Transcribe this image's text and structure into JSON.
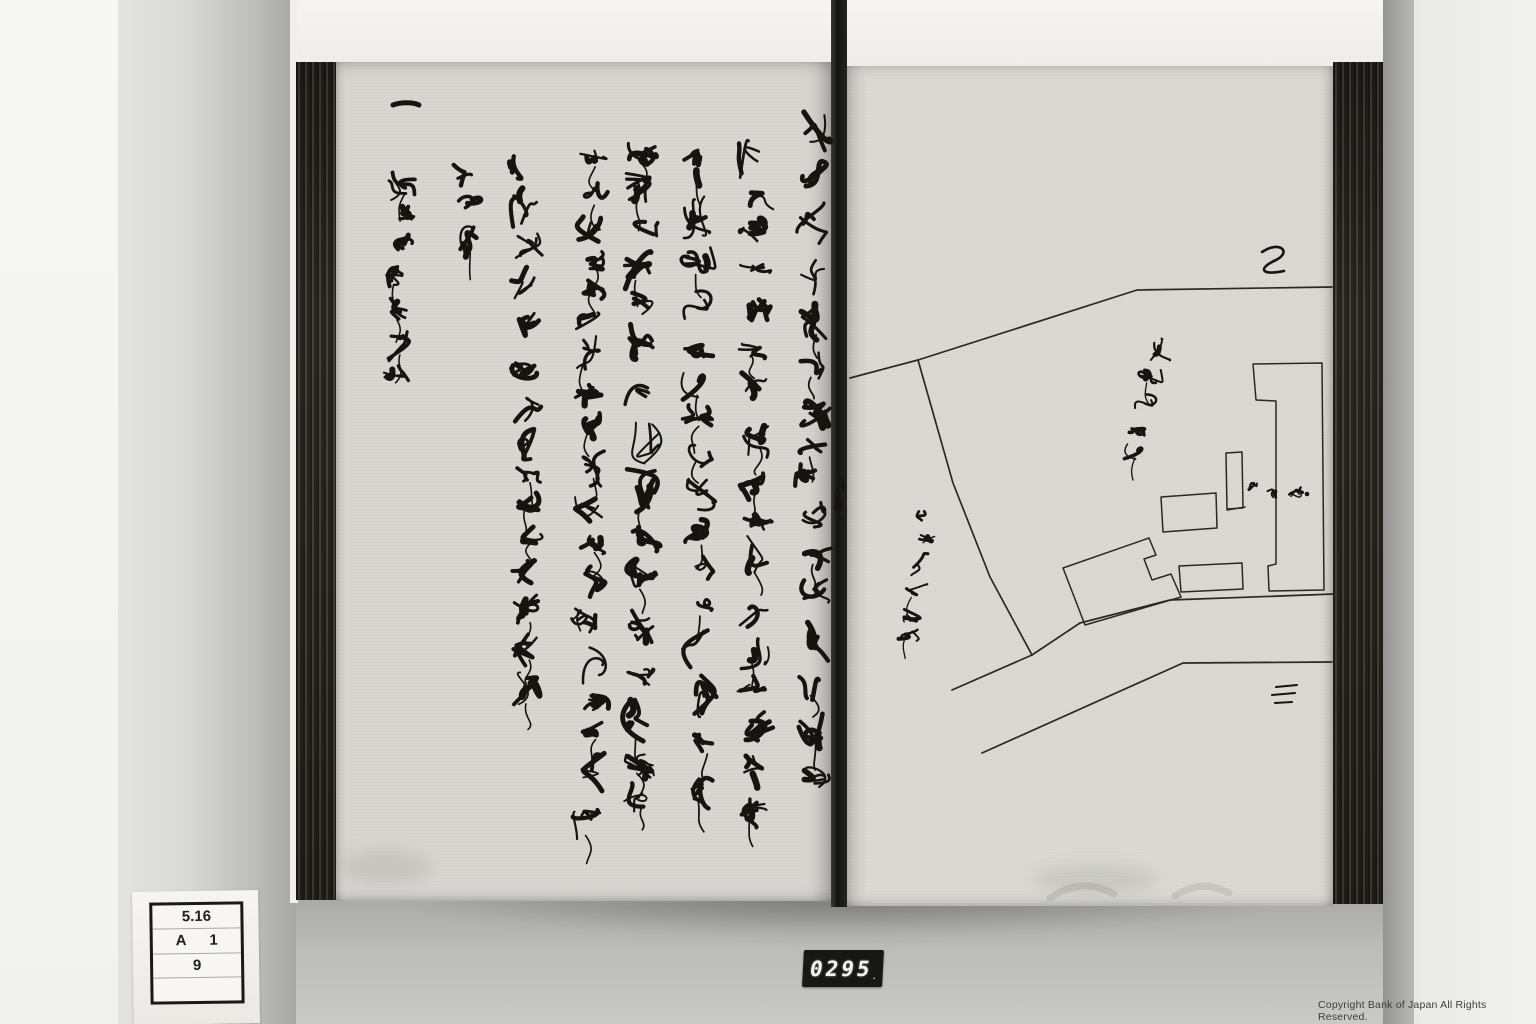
{
  "image_type": "black-and-white archival photograph of an open stitch-bound Japanese manuscript, left page handwritten cursive text, right page hand-drawn plot map",
  "overlays": {
    "label_card": {
      "rows": [
        [
          "5.16"
        ],
        [
          "A",
          "1"
        ],
        [
          "9"
        ],
        [
          ""
        ]
      ]
    },
    "counter": {
      "value": "0295",
      "dot": "."
    },
    "copyright": "Copyright Bank of Japan All Rights Reserved."
  },
  "palette": {
    "ink": "#17140f",
    "map_ink": "#2b2823",
    "paper_left": "#d7d6d1",
    "paper_right": "#dad9d4",
    "binding": "#332f28",
    "backdrop": "#c6c6c4"
  },
  "book": {
    "left_page": {
      "script": "cursive kuzushiji, vertical columns read right to left; largely illegible",
      "legible_fragments": "一 / 中 / 大坂店加番 / 御場 (approximate readings of cursive)",
      "heading_dash": {
        "x1": 393,
        "y": 105,
        "x2": 419
      },
      "gutter_mark": {
        "x": 843,
        "y1": 476,
        "y2": 506,
        "seed": 404,
        "sw": 1.6,
        "wob": 4,
        "ch": 14
      },
      "columns": [
        {
          "x": 813,
          "y1": 110,
          "y2": 792,
          "seed": 11,
          "sw": 3.6,
          "wob": 15,
          "ch": 36
        },
        {
          "x": 756,
          "y1": 133,
          "y2": 818,
          "seed": 22,
          "sw": 3.4,
          "wob": 15,
          "ch": 34
        },
        {
          "x": 699,
          "y1": 140,
          "y2": 812,
          "seed": 33,
          "sw": 3.5,
          "wob": 15,
          "ch": 34
        },
        {
          "x": 641,
          "y1": 142,
          "y2": 802,
          "seed": 44,
          "sw": 3.4,
          "wob": 15,
          "ch": 35
        },
        {
          "x": 590,
          "y1": 148,
          "y2": 838,
          "seed": 55,
          "sw": 3.3,
          "wob": 14,
          "ch": 33
        },
        {
          "x": 528,
          "y1": 156,
          "y2": 706,
          "seed": 66,
          "sw": 3.2,
          "wob": 14,
          "ch": 33
        },
        {
          "x": 467,
          "y1": 163,
          "y2": 252,
          "seed": 77,
          "sw": 3.2,
          "wob": 12,
          "ch": 30
        },
        {
          "x": 401,
          "y1": 172,
          "y2": 386,
          "seed": 88,
          "sw": 3.2,
          "wob": 13,
          "ch": 31
        }
      ]
    },
    "right_page": {
      "content": "hand-drawn estate/plot map with boundary lines, road, buildings and rotated cursive annotations",
      "boundary_to_gutter": [
        [
          850,
          378
        ],
        [
          918,
          360
        ]
      ],
      "boundary_top": [
        [
          918,
          360
        ],
        [
          1137,
          290
        ],
        [
          1332,
          287
        ]
      ],
      "boundary_left": [
        [
          918,
          360
        ],
        [
          953,
          483
        ],
        [
          990,
          577
        ],
        [
          1032,
          655
        ]
      ],
      "road_upper": [
        [
          952,
          690
        ],
        [
          1032,
          655
        ],
        [
          1080,
          623
        ],
        [
          1170,
          600
        ],
        [
          1334,
          594
        ]
      ],
      "road_lower": [
        [
          982,
          753
        ],
        [
          1183,
          663
        ],
        [
          1332,
          662
        ]
      ],
      "buildings": {
        "big_bracket": [
          [
            1253,
            364
          ],
          [
            1322,
            363
          ],
          [
            1324,
            590
          ],
          [
            1269,
            591
          ],
          [
            1268,
            566
          ],
          [
            1276,
            564
          ],
          [
            1276,
            401
          ],
          [
            1256,
            400
          ]
        ],
        "small_vertical_rect": [
          [
            1226,
            453
          ],
          [
            1242,
            452
          ],
          [
            1243,
            508
          ],
          [
            1227,
            509
          ]
        ],
        "small_rect_tick": [
          [
            1227,
            510
          ],
          [
            1245,
            507
          ]
        ],
        "medium_rect": [
          [
            1161,
            497
          ],
          [
            1216,
            493
          ],
          [
            1217,
            528
          ],
          [
            1163,
            532
          ]
        ],
        "bottom_rect": [
          [
            1179,
            566
          ],
          [
            1242,
            563
          ],
          [
            1243,
            589
          ],
          [
            1181,
            592
          ]
        ],
        "angled_building": [
          [
            1063,
            568
          ],
          [
            1149,
            538
          ],
          [
            1156,
            555
          ],
          [
            1144,
            559
          ],
          [
            1152,
            580
          ],
          [
            1171,
            574
          ],
          [
            1181,
            597
          ],
          [
            1085,
            625
          ]
        ]
      },
      "annotations": [
        {
          "tx": 1158,
          "ty": 336,
          "rot": 10,
          "len": 124,
          "seed": 101,
          "sw": 2.6,
          "wob": 11,
          "ch": 19
        },
        {
          "tx": 926,
          "ty": 510,
          "rot": 7,
          "len": 136,
          "seed": 202,
          "sw": 2.6,
          "wob": 11,
          "ch": 19
        },
        {
          "tx": 1248,
          "ty": 490,
          "rot": -90,
          "len": 56,
          "seed": 303,
          "sw": 1.8,
          "wob": 6,
          "ch": 14
        }
      ],
      "annotation_dot": [
        1307,
        494
      ],
      "signature_mark": "M1262,252 C1280,240 1292,252 1276,260 C1258,268 1260,276 1284,271",
      "san_mark": [
        [
          [
            1276,
            687
          ],
          [
            1297,
            685
          ]
        ],
        [
          [
            1272,
            695
          ],
          [
            1295,
            693
          ]
        ],
        [
          [
            1275,
            703
          ],
          [
            1292,
            702
          ]
        ]
      ],
      "corner_shadows": [
        "M1050,898 q32,-22 64,-4",
        "M1175,896 q26,-18 54,-3"
      ]
    }
  }
}
